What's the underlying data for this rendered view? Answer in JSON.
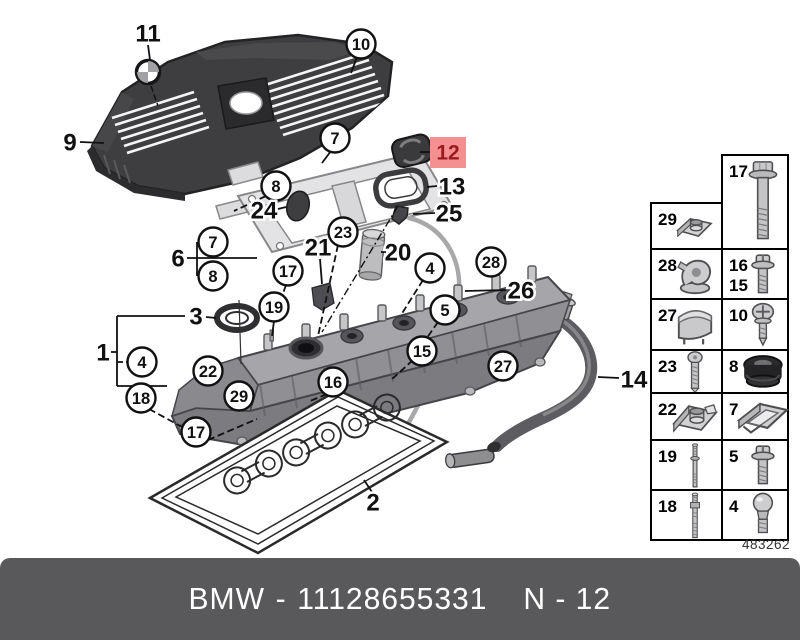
{
  "footer": {
    "brand": "BMW",
    "separator": "-",
    "part_number": "11128655331",
    "page_code": "N - 12"
  },
  "diagram_number": "483262",
  "colors": {
    "highlight_box": "#f59091",
    "highlight_text": "#9c1a1d",
    "footer_bg": "#59595b",
    "footer_text": "#ffffff",
    "line": "#111111"
  },
  "callouts": [
    {
      "label": "11",
      "style": "plain",
      "x": 148,
      "y": 33,
      "leader": [
        148,
        45,
        150,
        60
      ],
      "dashed": false
    },
    {
      "label": "10",
      "style": "circle",
      "x": 361,
      "y": 44,
      "leader": [
        357,
        57,
        351,
        73
      ],
      "dashed": false
    },
    {
      "label": "9",
      "style": "plain",
      "x": 70,
      "y": 142,
      "leader": [
        80,
        142,
        104,
        143
      ],
      "dashed": false
    },
    {
      "label": "7",
      "style": "circle",
      "x": 335,
      "y": 138,
      "leader": [
        331,
        151,
        322,
        163
      ],
      "dashed": false
    },
    {
      "label": "12",
      "style": "highlight",
      "x": 448,
      "y": 152,
      "leader": [
        420,
        152,
        431,
        152
      ],
      "dashed": false
    },
    {
      "label": "13",
      "style": "plain",
      "x": 452,
      "y": 186,
      "leader": [
        437,
        186,
        427,
        187
      ],
      "dashed": false
    },
    {
      "label": "8",
      "style": "circle",
      "x": 276,
      "y": 186,
      "leader": [
        266,
        196,
        234,
        211
      ],
      "dashed": true
    },
    {
      "label": "24",
      "style": "plain",
      "x": 264,
      "y": 210,
      "leader": [
        278,
        209,
        286,
        207
      ],
      "dashed": false
    },
    {
      "label": "25",
      "style": "plain",
      "x": 449,
      "y": 213,
      "leader": [
        435,
        213,
        413,
        214
      ],
      "dashed": false
    },
    {
      "label": "6",
      "style": "plain",
      "x": 178,
      "y": 258,
      "leader": null,
      "dashed": false
    },
    {
      "label": "7",
      "style": "circle",
      "x": 213,
      "y": 242,
      "leader": null,
      "dashed": false
    },
    {
      "label": "8",
      "style": "circle",
      "x": 213,
      "y": 276,
      "leader": null,
      "dashed": false
    },
    {
      "label": "21",
      "style": "plain",
      "x": 318,
      "y": 247,
      "leader": [
        320,
        259,
        322,
        284
      ],
      "dashed": false
    },
    {
      "label": "23",
      "style": "circle",
      "x": 343,
      "y": 232,
      "leader": [
        338,
        245,
        318,
        336
      ],
      "dashed": true
    },
    {
      "label": "20",
      "style": "plain",
      "x": 398,
      "y": 252,
      "leader": [
        386,
        252,
        381,
        252
      ],
      "dashed": false
    },
    {
      "label": "17",
      "style": "circle",
      "x": 288,
      "y": 271,
      "leader": [
        286,
        285,
        281,
        299
      ],
      "dashed": true
    },
    {
      "label": "28",
      "style": "circle",
      "x": 491,
      "y": 262,
      "leader": null,
      "dashed": false
    },
    {
      "label": "26",
      "style": "plain",
      "x": 521,
      "y": 290,
      "leader": [
        506,
        290,
        465,
        291
      ],
      "dashed": false
    },
    {
      "label": "19",
      "style": "circle",
      "x": 274,
      "y": 307,
      "leader": [
        274,
        321,
        272,
        336
      ],
      "dashed": false
    },
    {
      "label": "3",
      "style": "plain",
      "x": 196,
      "y": 316,
      "leader": [
        206,
        317,
        216,
        318
      ],
      "dashed": false
    },
    {
      "label": "4",
      "style": "circle",
      "x": 430,
      "y": 268,
      "leader": [
        423,
        280,
        401,
        315
      ],
      "dashed": true
    },
    {
      "label": "5",
      "style": "circle",
      "x": 445,
      "y": 310,
      "leader": [
        438,
        322,
        424,
        342
      ],
      "dashed": true
    },
    {
      "label": "1",
      "style": "plain",
      "x": 103,
      "y": 352,
      "leader": null,
      "dashed": false
    },
    {
      "label": "4",
      "style": "circle",
      "x": 142,
      "y": 362,
      "leader": null,
      "dashed": false
    },
    {
      "label": "15",
      "style": "circle",
      "x": 422,
      "y": 351,
      "leader": [
        413,
        360,
        391,
        380
      ],
      "dashed": true
    },
    {
      "label": "22",
      "style": "circle",
      "x": 208,
      "y": 371,
      "leader": null,
      "dashed": false
    },
    {
      "label": "16",
      "style": "circle",
      "x": 333,
      "y": 382,
      "leader": [
        327,
        394,
        310,
        401
      ],
      "dashed": true
    },
    {
      "label": "27",
      "style": "circle",
      "x": 503,
      "y": 366,
      "leader": null,
      "dashed": false
    },
    {
      "label": "14",
      "style": "plain",
      "x": 634,
      "y": 379,
      "leader": [
        619,
        378,
        598,
        377
      ],
      "dashed": false
    },
    {
      "label": "29",
      "style": "circle",
      "x": 239,
      "y": 396,
      "leader": null,
      "dashed": false
    },
    {
      "label": "18",
      "style": "circle",
      "x": 141,
      "y": 398,
      "leader": [
        149,
        409,
        184,
        428
      ],
      "dashed": true
    },
    {
      "label": "17",
      "style": "circle",
      "x": 196,
      "y": 432,
      "leader": [
        208,
        440,
        257,
        419
      ],
      "dashed": true
    },
    {
      "label": "2",
      "style": "plain",
      "x": 373,
      "y": 502,
      "leader": [
        372,
        492,
        364,
        480
      ],
      "dashed": false
    }
  ],
  "parts_grid": {
    "cells": [
      {
        "labels": [
          "17"
        ],
        "icon": "flange-bolt",
        "x": 722,
        "y": 155,
        "w": 66,
        "h": 94,
        "s": 1.05
      },
      {
        "labels": [
          "29"
        ],
        "icon": "speed-nut",
        "x": 651,
        "y": 203,
        "w": 71,
        "h": 46,
        "s": 1.15
      },
      {
        "labels": [
          "28"
        ],
        "icon": "hose-clip",
        "x": 651,
        "y": 249,
        "w": 71,
        "h": 50,
        "s": 1.3
      },
      {
        "labels": [
          "16",
          "15"
        ],
        "icon": "screw-washer",
        "x": 722,
        "y": 249,
        "w": 66,
        "h": 50,
        "s": 1.1
      },
      {
        "labels": [
          "27"
        ],
        "icon": "spring-clip",
        "x": 651,
        "y": 299,
        "w": 71,
        "h": 51,
        "s": 1.35
      },
      {
        "labels": [
          "10"
        ],
        "icon": "phillips-screw",
        "x": 722,
        "y": 299,
        "w": 66,
        "h": 51,
        "s": 1.15
      },
      {
        "labels": [
          "23"
        ],
        "icon": "torx-screw",
        "x": 651,
        "y": 350,
        "w": 71,
        "h": 43,
        "s": 1.0
      },
      {
        "labels": [
          "8"
        ],
        "icon": "grommet",
        "x": 722,
        "y": 350,
        "w": 66,
        "h": 43,
        "s": 1.25
      },
      {
        "labels": [
          "22"
        ],
        "icon": "speed-nut-large",
        "x": 651,
        "y": 393,
        "w": 71,
        "h": 47,
        "s": 1.25
      },
      {
        "labels": [
          "7"
        ],
        "icon": "sheet-clip",
        "x": 722,
        "y": 393,
        "w": 66,
        "h": 47,
        "s": 1.5
      },
      {
        "labels": [
          "19"
        ],
        "icon": "stud",
        "x": 651,
        "y": 440,
        "w": 71,
        "h": 50,
        "s": 0.95
      },
      {
        "labels": [
          "5"
        ],
        "icon": "screw-washer",
        "x": 722,
        "y": 440,
        "w": 66,
        "h": 50,
        "s": 1.1
      },
      {
        "labels": [
          "18"
        ],
        "icon": "stud-long",
        "x": 651,
        "y": 490,
        "w": 71,
        "h": 50,
        "s": 0.9
      },
      {
        "labels": [
          "4"
        ],
        "icon": "ball-stud",
        "x": 722,
        "y": 490,
        "w": 66,
        "h": 50,
        "s": 1.1
      }
    ]
  }
}
